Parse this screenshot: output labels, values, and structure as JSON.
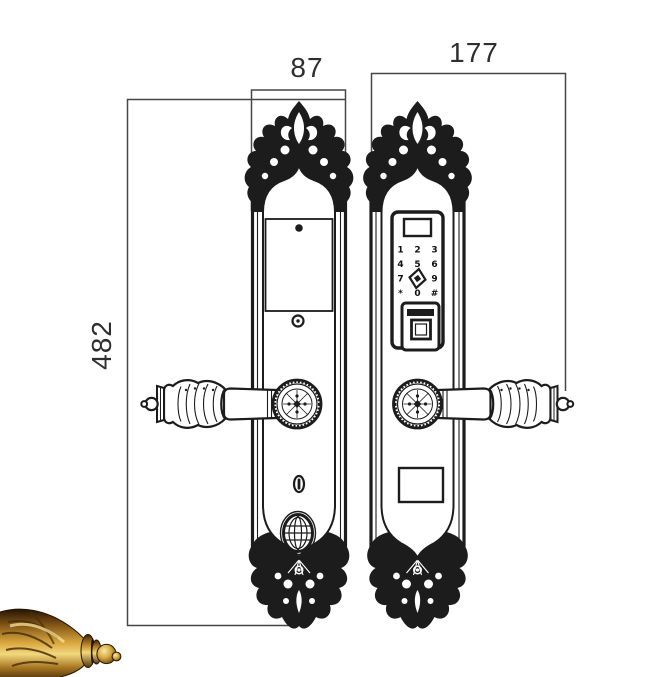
{
  "page": {
    "background": "#ffffff",
    "width_px": 659,
    "height_px": 677
  },
  "drawing": {
    "kind": "technical dimension drawing",
    "subject": "classical ornate smart door lock - interior and exterior escutcheon plates",
    "line_color": "#1c1c1c",
    "dimension_line_color": "#474747",
    "dimension_text_color": "#2e2e2e"
  },
  "dimensions": {
    "plate_width": "87",
    "overall_width_with_handle": "177",
    "plate_height": "482"
  },
  "keypad": {
    "rows": [
      [
        "1",
        "2",
        "3"
      ],
      [
        "4",
        "5",
        "6"
      ],
      [
        "7",
        "",
        "9"
      ],
      [
        "*",
        "0",
        "#"
      ]
    ],
    "center_logo": "diamond"
  },
  "photo_inset": {
    "subject": "brass handle finial close-up",
    "gold_palette": [
      "#2e1c06",
      "#8a5a18",
      "#d9a73e",
      "#f2d87e"
    ]
  }
}
